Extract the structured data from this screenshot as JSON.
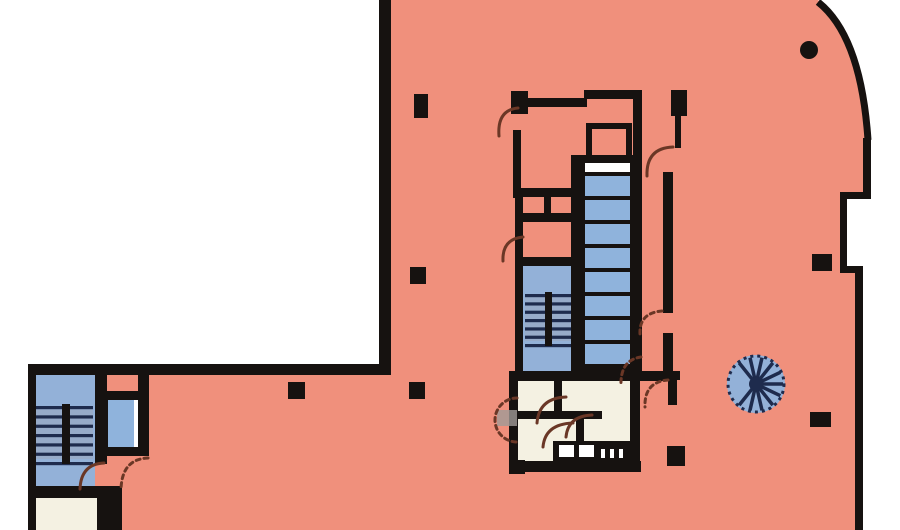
{
  "document": {
    "kind": "architectural-floor-plan",
    "canvas": {
      "width": 900,
      "height": 530
    }
  },
  "colors": {
    "outside": "#ffffff",
    "slab": "#f0907c",
    "wall": "#161210",
    "room_blue": "#93b1d8",
    "room_cream": "#f4f1e2",
    "car_blue": "#8fb3dc",
    "car_light": "#ffffff",
    "shaft": "#161210",
    "navy": "#1e2b4d",
    "tread_gray": "#9aa6bd",
    "door_arc": "#6a3726",
    "leaf_gray": "#a09a96",
    "white": "#ffffff"
  },
  "plan": {
    "slab_path": "M 379,0 L 818,0 Q 862,34 869,141 L 869,198 L 843,198 L 843,270 L 858,270 L 858,530 L 30,530 L 30,366 L 379,366 Z",
    "boundary_arcs": [
      {
        "d": "M 818,2 Q 861,36 868,140",
        "width": 7
      }
    ],
    "rooms": [
      {
        "name": "stairwell-room-left-core",
        "x": 34,
        "y": 375,
        "w": 61,
        "h": 113,
        "fill": "room_blue"
      },
      {
        "name": "room-left-core-bottom",
        "x": 34,
        "y": 498,
        "w": 63,
        "h": 32,
        "fill": "room_cream"
      },
      {
        "name": "elevator-car-left-core",
        "x": 108,
        "y": 400,
        "w": 26,
        "h": 47,
        "fill": "car_blue"
      },
      {
        "name": "elevator-door-gap",
        "x": 134,
        "y": 400,
        "w": 8,
        "h": 47,
        "fill": "white"
      },
      {
        "name": "stairwell-room-main-core",
        "x": 523,
        "y": 266,
        "w": 48,
        "h": 110,
        "fill": "room_blue"
      },
      {
        "name": "restroom-area-main-core",
        "x": 518,
        "y": 381,
        "w": 112,
        "h": 80,
        "fill": "room_cream"
      }
    ],
    "elevator_shaft": {
      "x": 580,
      "y": 160,
      "w": 56,
      "h": 218
    },
    "elevator_cars": [
      {
        "x": 585,
        "y": 163,
        "w": 45,
        "h": 9,
        "fill": "car_light"
      },
      {
        "x": 585,
        "y": 176,
        "w": 45,
        "h": 20,
        "fill": "car_blue"
      },
      {
        "x": 585,
        "y": 200,
        "w": 45,
        "h": 20,
        "fill": "car_blue"
      },
      {
        "x": 585,
        "y": 224,
        "w": 45,
        "h": 20,
        "fill": "car_blue"
      },
      {
        "x": 585,
        "y": 248,
        "w": 45,
        "h": 20,
        "fill": "car_blue"
      },
      {
        "x": 585,
        "y": 272,
        "w": 45,
        "h": 20,
        "fill": "car_blue"
      },
      {
        "x": 585,
        "y": 296,
        "w": 45,
        "h": 20,
        "fill": "car_blue"
      },
      {
        "x": 585,
        "y": 320,
        "w": 45,
        "h": 20,
        "fill": "car_blue"
      },
      {
        "x": 585,
        "y": 344,
        "w": 45,
        "h": 20,
        "fill": "car_blue"
      }
    ],
    "walls": [
      [
        379,
        0,
        12,
        370
      ],
      [
        28,
        364,
        363,
        11
      ],
      [
        28,
        364,
        8,
        166
      ],
      [
        863,
        138,
        8,
        60
      ],
      [
        840,
        192,
        31,
        7
      ],
      [
        840,
        192,
        7,
        80
      ],
      [
        840,
        266,
        23,
        7
      ],
      [
        855,
        266,
        8,
        264
      ],
      [
        95,
        374,
        12,
        90
      ],
      [
        97,
        486,
        25,
        44
      ],
      [
        28,
        486,
        77,
        12
      ],
      [
        138,
        368,
        11,
        88
      ],
      [
        101,
        391,
        48,
        9
      ],
      [
        101,
        447,
        48,
        9
      ],
      [
        101,
        391,
        7,
        65
      ],
      [
        142,
        391,
        7,
        65
      ],
      [
        511,
        91,
        17,
        23
      ],
      [
        517,
        98,
        70,
        9
      ],
      [
        584,
        90,
        58,
        9
      ],
      [
        633,
        98,
        9,
        62
      ],
      [
        671,
        90,
        16,
        26
      ],
      [
        675,
        114,
        6,
        34
      ],
      [
        663,
        172,
        10,
        141
      ],
      [
        663,
        333,
        10,
        42
      ],
      [
        513,
        130,
        8,
        68
      ],
      [
        515,
        196,
        8,
        180
      ],
      [
        515,
        188,
        62,
        9
      ],
      [
        544,
        196,
        7,
        20
      ],
      [
        515,
        213,
        62,
        9
      ],
      [
        515,
        257,
        62,
        9
      ],
      [
        571,
        155,
        11,
        222
      ],
      [
        634,
        158,
        8,
        219
      ],
      [
        571,
        155,
        71,
        7
      ],
      [
        509,
        371,
        165,
        10
      ],
      [
        509,
        379,
        9,
        93
      ],
      [
        509,
        461,
        132,
        11
      ],
      [
        630,
        371,
        10,
        101
      ],
      [
        554,
        379,
        8,
        38
      ],
      [
        516,
        411,
        86,
        8
      ],
      [
        576,
        419,
        8,
        28
      ],
      [
        553,
        441,
        78,
        20
      ],
      [
        664,
        371,
        16,
        9
      ],
      [
        668,
        379,
        9,
        26
      ],
      [
        586,
        123,
        46,
        38
      ]
    ],
    "insets": [
      {
        "name": "small-room-main-core-top",
        "x": 592,
        "y": 129,
        "w": 34,
        "h": 26,
        "fill": "slab"
      }
    ],
    "fixtures": [
      {
        "x": 559,
        "y": 445,
        "w": 15,
        "h": 12
      },
      {
        "x": 579,
        "y": 445,
        "w": 15,
        "h": 12
      },
      {
        "x": 601,
        "y": 449,
        "w": 4,
        "h": 9
      },
      {
        "x": 610,
        "y": 449,
        "w": 4,
        "h": 9
      },
      {
        "x": 619,
        "y": 449,
        "w": 4,
        "h": 9
      }
    ],
    "stairs": [
      {
        "name": "stair-treads-left-core",
        "x": 36,
        "y": 406,
        "w": 57,
        "h": 56,
        "divider_x": 62,
        "divider_w": 8,
        "stripes": 6
      },
      {
        "name": "stair-treads-main-core",
        "x": 525,
        "y": 294,
        "w": 46,
        "h": 50,
        "divider_x": 545,
        "divider_w": 7,
        "stripes": 6
      }
    ],
    "columns": [
      {
        "shape": "rect",
        "x": 414,
        "y": 94,
        "w": 14,
        "h": 24
      },
      {
        "shape": "rect",
        "x": 410,
        "y": 267,
        "w": 16,
        "h": 17
      },
      {
        "shape": "rect",
        "x": 288,
        "y": 382,
        "w": 17,
        "h": 17
      },
      {
        "shape": "rect",
        "x": 409,
        "y": 382,
        "w": 16,
        "h": 17
      },
      {
        "shape": "rect",
        "x": 509,
        "y": 460,
        "w": 16,
        "h": 14
      },
      {
        "shape": "rect",
        "x": 667,
        "y": 446,
        "w": 18,
        "h": 20
      },
      {
        "shape": "rect",
        "x": 810,
        "y": 412,
        "w": 21,
        "h": 15
      },
      {
        "shape": "rect",
        "x": 812,
        "y": 254,
        "w": 20,
        "h": 17
      },
      {
        "shape": "circle",
        "cx": 809,
        "cy": 50,
        "r": 9
      }
    ],
    "door_arcs": [
      {
        "d": "M 518,108 Q 497,110 499,136",
        "dashed": false
      },
      {
        "d": "M 673,147 Q 646,148 647,176",
        "dashed": false
      },
      {
        "d": "M 523,237 Q 502,239 503,261",
        "dashed": false
      },
      {
        "d": "M 662,311 Q 639,313 640,334",
        "dashed": true
      },
      {
        "d": "M 641,357 Q 620,360 621,386",
        "dashed": true
      },
      {
        "d": "M 668,380 Q 644,382 645,407",
        "dashed": true
      },
      {
        "d": "M 517,398 A 22,22 0 0 0 517,442",
        "dashed": true
      },
      {
        "d": "M 566,397 Q 539,398 537,423",
        "dashed": false
      },
      {
        "d": "M 573,423 Q 545,424 543,447",
        "dashed": false
      },
      {
        "d": "M 592,415 Q 568,416 566,437",
        "dashed": false
      },
      {
        "d": "M 104,463 Q 81,464 80,489",
        "dashed": false
      },
      {
        "d": "M 148,458 Q 122,459 121,489",
        "dashed": true
      }
    ],
    "door_leaf": {
      "x": 497,
      "y": 410,
      "w": 20,
      "h": 16
    },
    "spiral_stair": {
      "cx": 756,
      "cy": 384,
      "r": 29,
      "spokes": 14,
      "gap_start": 150,
      "gap_end": 215
    }
  }
}
